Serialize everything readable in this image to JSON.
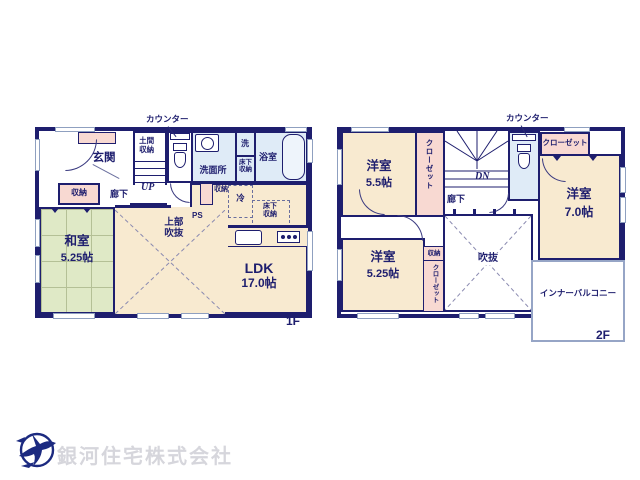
{
  "colors": {
    "wall_navy": "#1e1e6e",
    "room_cream": "#f8ead0",
    "tatami_green": "#dfe9c6",
    "storage_pink": "#f8d9d2",
    "wet_area_blue": "#dfebf7",
    "logo_navy": "#1c2a80",
    "company_text_gray": "#d6d6dc"
  },
  "floor1": {
    "counter": "カウンター",
    "genkan": "玄関",
    "doma_storage": "土間収納",
    "up": "UP",
    "washroom": "洗面所",
    "laundry": "洗",
    "underfloor_storage": "床下収納",
    "bathroom": "浴室",
    "storage": "収納",
    "hallway": "廊下",
    "fridge": "冷",
    "ps": "PS",
    "open_ceiling": "上部吹抜",
    "washitsu": {
      "name": "和室",
      "size": "5.25帖"
    },
    "ldk": {
      "name": "LDK",
      "size": "17.0帖"
    },
    "floor_label": "1F"
  },
  "floor2": {
    "counter": "カウンター",
    "closet": "クローゼット",
    "dn": "DN",
    "hallway": "廊下",
    "storage": "収納",
    "void_label": "吹抜",
    "balcony": "インナーバルコニー",
    "rooms": {
      "a": {
        "name": "洋室",
        "size": "5.5帖"
      },
      "b": {
        "name": "洋室",
        "size": "7.0帖"
      },
      "c": {
        "name": "洋室",
        "size": "5.25帖"
      }
    },
    "floor_label": "2F"
  },
  "footer": {
    "company": "銀河住宅株式会社"
  }
}
